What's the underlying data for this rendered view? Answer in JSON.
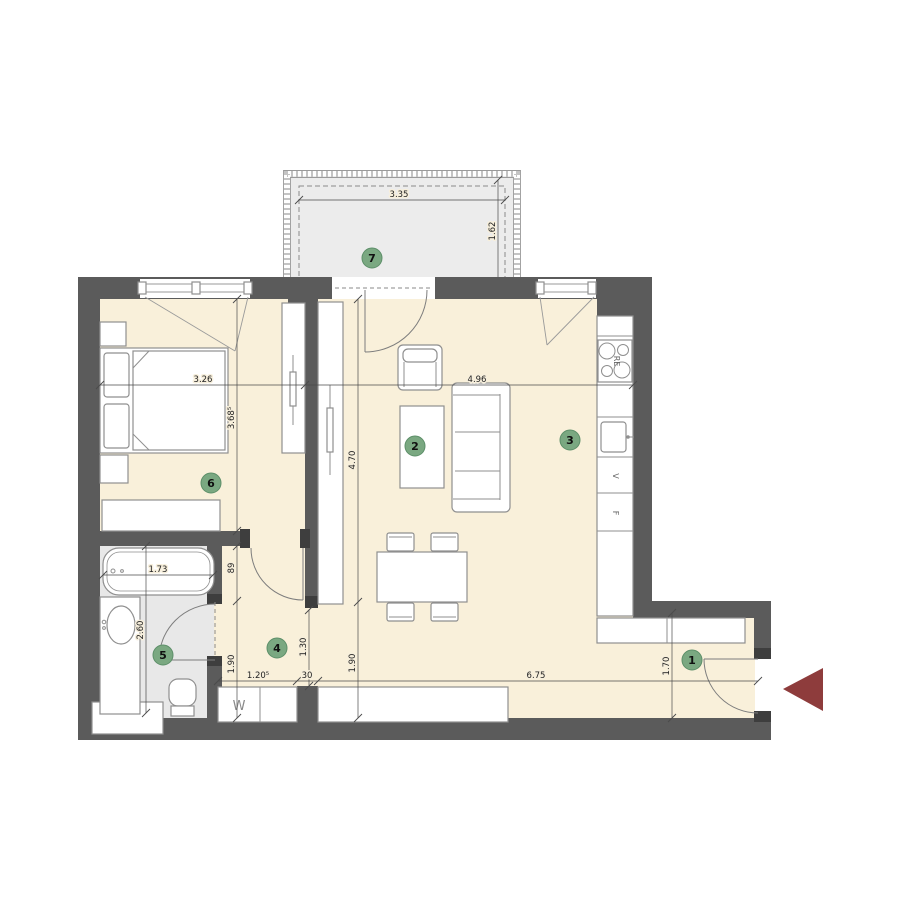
{
  "title": "apartment-floor-plan",
  "rooms": [
    {
      "number": "1"
    },
    {
      "number": "2"
    },
    {
      "number": "3"
    },
    {
      "number": "4"
    },
    {
      "number": "5"
    },
    {
      "number": "6"
    },
    {
      "number": "7"
    }
  ],
  "dims": {
    "balcony_width": "3.35",
    "balcony_depth": "1.62",
    "bedroom_width": "3.26",
    "bedroom_depth": "3.68⁵",
    "living_width": "4.96",
    "living_height": "4.70",
    "living_lower": "1.90",
    "hall_upper": "89",
    "hall_lower": "1.90",
    "hall_opening": "1.30",
    "closet_width": "1.20⁵",
    "pillar_width": "30",
    "bottom_span": "6.75",
    "bath_width": "1.73",
    "bath_height": "2.60",
    "entry_height": "1.70"
  },
  "labels": {
    "washing_machine": "W",
    "dishwasher": "V",
    "fridge": "F",
    "stove": "RE"
  },
  "colors": {
    "wall": "#5b5b5b",
    "floor": "#f9f0da",
    "wet_floor": "#e8e8e8",
    "balcony_floor": "#ececec",
    "badge_green": "#7aa881",
    "entry_arrow": "#8e3c3c"
  }
}
